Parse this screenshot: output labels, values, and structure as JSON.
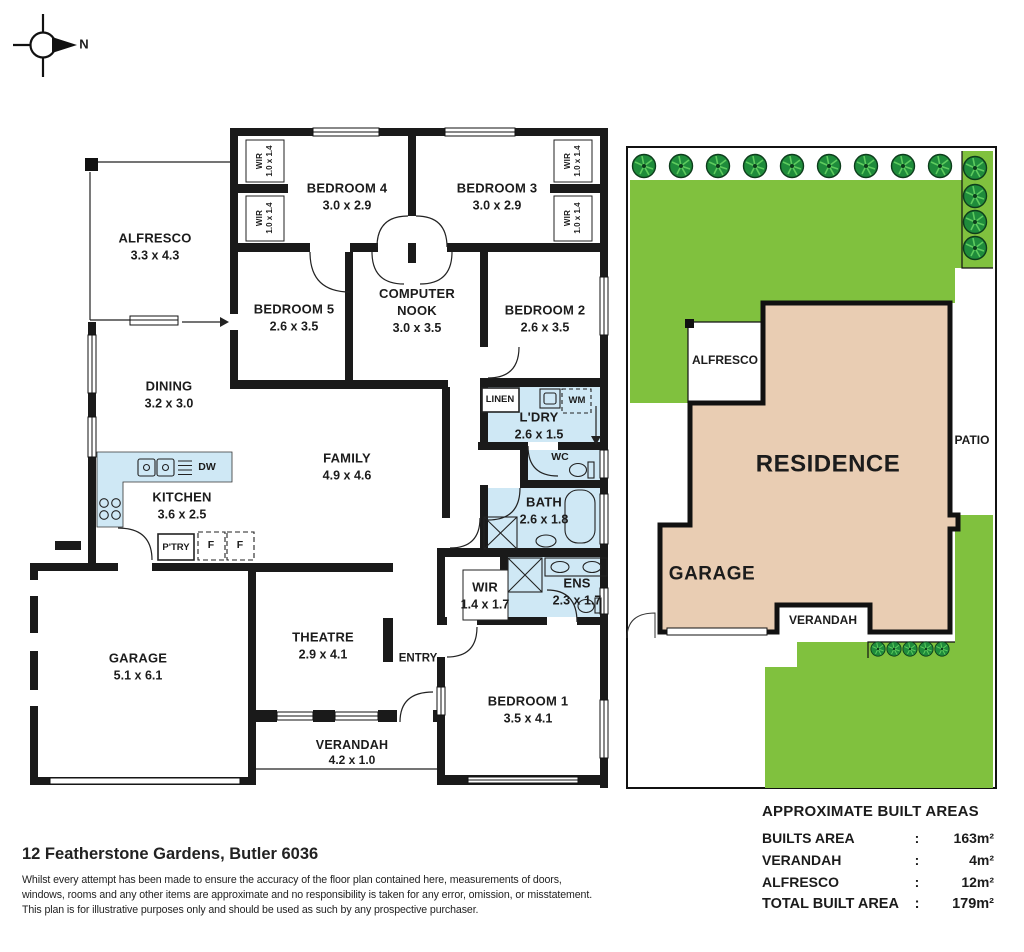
{
  "compass": {
    "n": "N"
  },
  "colors": {
    "wall": "#1a1a1a",
    "wet_area": "#cfe8f5",
    "lawn": "#80c13e",
    "tree": "#1f8c3b",
    "residence_fill": "#e9cdb3"
  },
  "fp": {
    "rooms": {
      "alfresco": {
        "name": "ALFRESCO",
        "dims": "3.3 x 4.3"
      },
      "bedroom4": {
        "name": "BEDROOM 4",
        "dims": "3.0 x 2.9"
      },
      "bedroom3": {
        "name": "BEDROOM 3",
        "dims": "3.0 x 2.9"
      },
      "bedroom5": {
        "name": "BEDROOM 5",
        "dims": "2.6 x 3.5"
      },
      "nook": {
        "name": "COMPUTER NOOK",
        "dims": "3.0 x 3.5"
      },
      "bedroom2": {
        "name": "BEDROOM 2",
        "dims": "2.6 x 3.5"
      },
      "dining": {
        "name": "DINING",
        "dims": "3.2 x 3.0"
      },
      "family": {
        "name": "FAMILY",
        "dims": "4.9 x 4.6"
      },
      "kitchen": {
        "name": "KITCHEN",
        "dims": "3.6 x 2.5"
      },
      "laundry": {
        "name": "L'DRY",
        "dims": "2.6 x 1.5"
      },
      "bath": {
        "name": "BATH",
        "dims": "2.6 x 1.8"
      },
      "wir_bed1": {
        "name": "WIR",
        "dims": "1.4 x 1.7"
      },
      "ens": {
        "name": "ENS",
        "dims": "2.3 x 1.7"
      },
      "garage": {
        "name": "GARAGE",
        "dims": "5.1 x 6.1"
      },
      "theatre": {
        "name": "THEATRE",
        "dims": "2.9 x 4.1"
      },
      "bedroom1": {
        "name": "BEDROOM 1",
        "dims": "3.5 x 4.1"
      },
      "verandah": {
        "name": "VERANDAH",
        "dims": "4.2 x 1.0"
      },
      "wir_closet": {
        "name": "WIR",
        "dims": "1.0 x 1.4"
      }
    },
    "labels": {
      "wc": "WC",
      "entry": "ENTRY",
      "linen": "LINEN",
      "wm": "WM",
      "dw": "DW",
      "ptry": "P'TRY",
      "fridge": "F"
    }
  },
  "site": {
    "residence": "RESIDENCE",
    "garage": "GARAGE",
    "alfresco": "ALFRESCO",
    "verandah": "VERANDAH",
    "patio": "PATIO"
  },
  "panel": {
    "title": "APPROXIMATE BUILT AREAS",
    "colon": ":",
    "rows": [
      {
        "label": "BUILTS AREA",
        "value": "163m²"
      },
      {
        "label": "VERANDAH",
        "value": "4m²"
      },
      {
        "label": "ALFRESCO",
        "value": "12m²"
      },
      {
        "label": "TOTAL BUILT AREA",
        "value": "179m²"
      }
    ]
  },
  "footer": {
    "address": "12 Featherstone Gardens, Butler 6036",
    "disclaimer": [
      "Whilst every attempt has been made to ensure the accuracy of the floor plan contained here, measurements of doors,",
      "windows, rooms and any other items are approximate and no responsibility is taken for any error, omission, or misstatement.",
      "This plan is for illustrative purposes only and should be used as such by any prospective purchaser."
    ]
  }
}
